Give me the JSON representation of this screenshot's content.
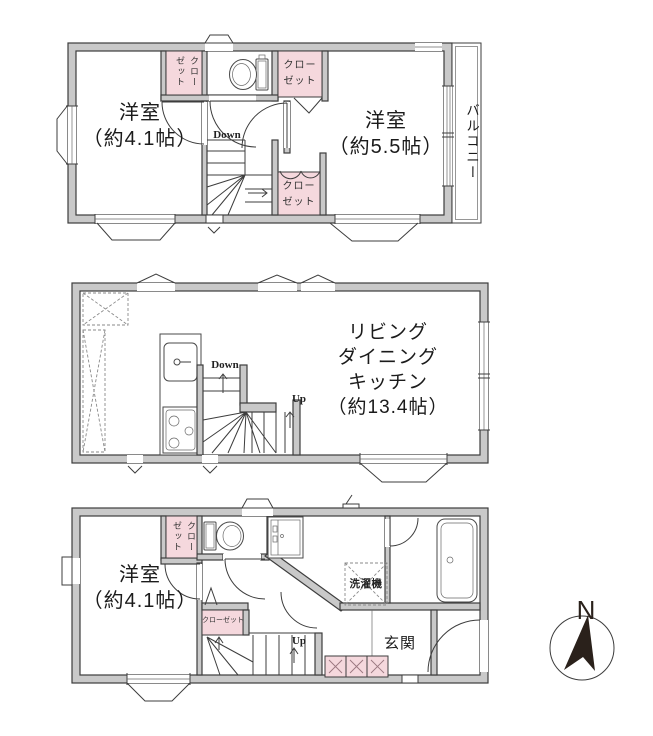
{
  "title": "3-story house floor plan",
  "colors": {
    "wall_gray": "#c9c9c9",
    "wall_outline": "#3d3d3d",
    "closet_pink": "#f5d8dd",
    "line_dark": "#3d3d3d",
    "compass_needle": "#2a211b",
    "background": "#ffffff"
  },
  "icons": {
    "toilet": "toilet-icon",
    "washbasin": "washbasin-icon",
    "bathtub": "bathtub-icon",
    "kitchen_sink": "kitchen-sink-icon",
    "stove": "stove-icon",
    "washing_machine_box": "washing-machine-icon",
    "stairs": "stairs-icon",
    "compass": "compass-icon"
  },
  "floor_top": {
    "room_left": "洋室\n（約4.1帖）",
    "room_right": "洋室\n（約5.5帖）",
    "balcony": "バルコニー",
    "closet_top_left": "クローゼット",
    "closet_top_right": "クローゼット",
    "closet_bottom": "クローゼット",
    "stairs_down": "Down"
  },
  "floor_middle": {
    "ldk": "リビング\nダイニング\nキッチン\n（約13.4帖）",
    "stairs_down": "Down",
    "stairs_up": "Up"
  },
  "floor_bottom": {
    "room_left": "洋室\n（約4.1帖）",
    "closet_top": "クローゼット",
    "closet_mid": "クローゼット",
    "washer": "洗濯機",
    "entrance": "玄関",
    "stairs_up": "Up"
  },
  "compass": {
    "north": "N"
  }
}
